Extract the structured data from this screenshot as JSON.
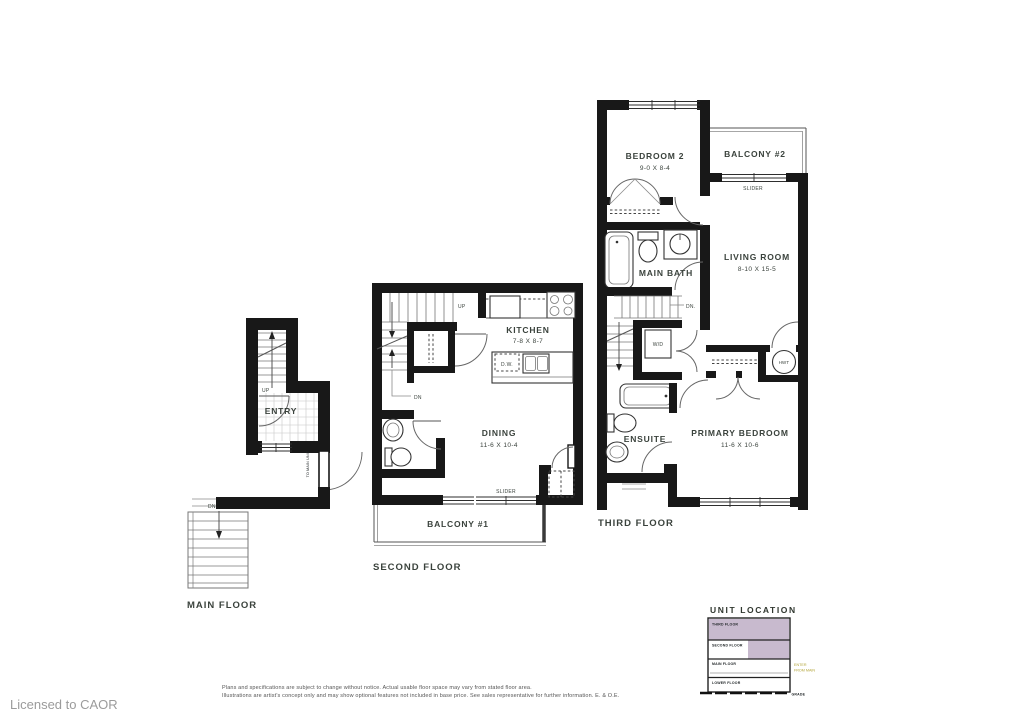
{
  "main_floor": {
    "title": "MAIN FLOOR",
    "entry": "ENTRY",
    "up": "UP",
    "dn": "DN",
    "note": "TO MAIN UNIT"
  },
  "second_floor": {
    "title": "SECOND FLOOR",
    "kitchen": "KITCHEN",
    "kitchen_dims": "7-8 X 8-7",
    "dining": "DINING",
    "dining_dims": "11-6 X 10-4",
    "dw": "D.W.",
    "up": "UP",
    "dn": "DN",
    "slider": "SLIDER",
    "balcony": "BALCONY #1"
  },
  "third_floor": {
    "title": "THIRD FLOOR",
    "bedroom2": "BEDROOM 2",
    "bedroom2_dims": "9-0 X 8-4",
    "balcony": "BALCONY #2",
    "slider": "SLIDER",
    "living": "LIVING ROOM",
    "living_dims": "8-10 X 15-5",
    "main_bath": "MAIN BATH",
    "wd": "W/D",
    "hwt": "HWT",
    "dn": "DN.",
    "ensuite": "ENSUITE",
    "primary": "PRIMARY BEDROOM",
    "primary_dims": "11-6 X 10-6"
  },
  "unit_location": {
    "title": "UNIT LOCATION",
    "floors": [
      "THIRD FLOOR",
      "SECOND FLOOR",
      "MAIN FLOOR",
      "LOWER FLOOR"
    ],
    "grade": "GRADE",
    "note_line1": "ENTER",
    "note_line2": "FROM MAIN",
    "highlight_color": "#c8bace",
    "note_color": "#b2a437"
  },
  "footer": {
    "disclaimer_line1": "Plans and specifications are subject to change without notice. Actual usable floor space may vary from stated floor area.",
    "disclaimer_line2": "Illustrations are artist's concept only and may show optional features not included in base price. See sales representative for further information. E. & O.E.",
    "license": "Licensed to CAOR"
  }
}
